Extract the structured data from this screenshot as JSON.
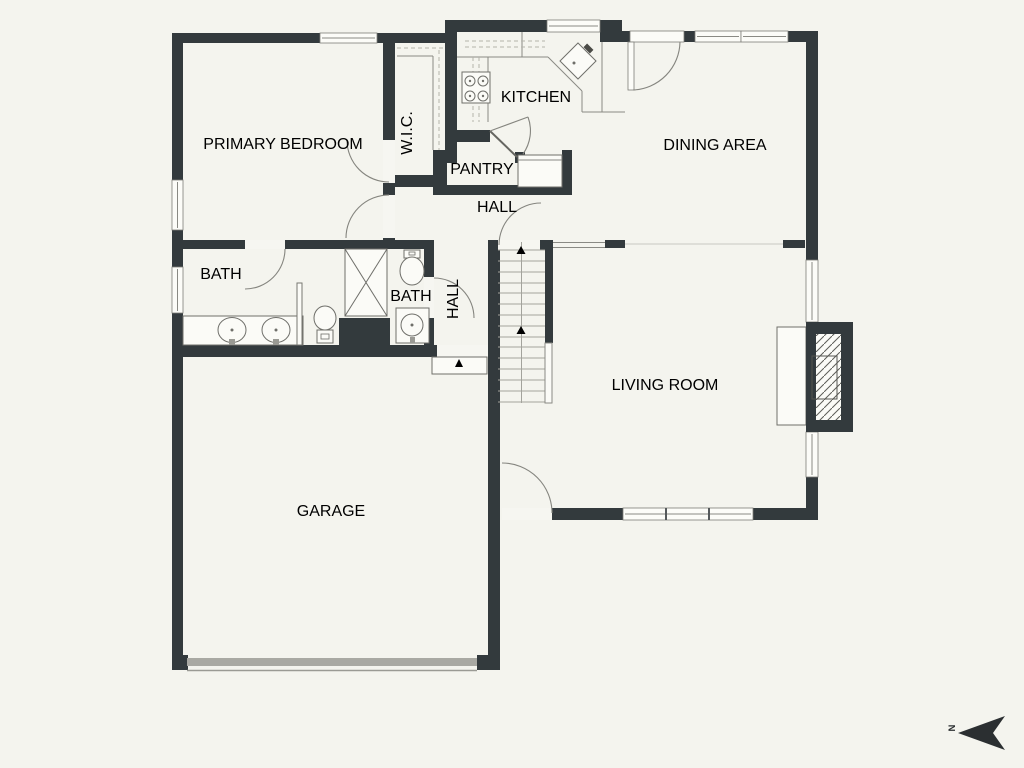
{
  "meta": {
    "type": "residential-floor-plan",
    "view": "top-down"
  },
  "colors": {
    "background": "#f4f4ee",
    "wall": "#333a3d",
    "fixture_line": "#8a8a84",
    "text": "#3f3f3d",
    "garage_door": "#a9a9a3"
  },
  "rooms": {
    "primary_bedroom": {
      "label": "PRIMARY BEDROOM"
    },
    "wic": {
      "label": "W.I.C."
    },
    "kitchen": {
      "label": "KITCHEN"
    },
    "pantry": {
      "label": "PANTRY"
    },
    "hall_upper": {
      "label": "HALL"
    },
    "dining": {
      "label": "DINING AREA"
    },
    "bath_primary": {
      "label": "BATH"
    },
    "bath_hall": {
      "label": "BATH"
    },
    "hall_lower": {
      "label": "HALL"
    },
    "living": {
      "label": "LIVING ROOM"
    },
    "garage": {
      "label": "GARAGE"
    }
  },
  "fixtures": [
    "stove",
    "kitchen-sink",
    "refrigerator-alcove",
    "shower",
    "double-vanity",
    "toilet",
    "toilet",
    "vanity-sink",
    "staircase-up",
    "fireplace",
    "garage-door",
    "garage-step-landing"
  ],
  "compass": {
    "label": "N",
    "arrow_points": "left"
  }
}
